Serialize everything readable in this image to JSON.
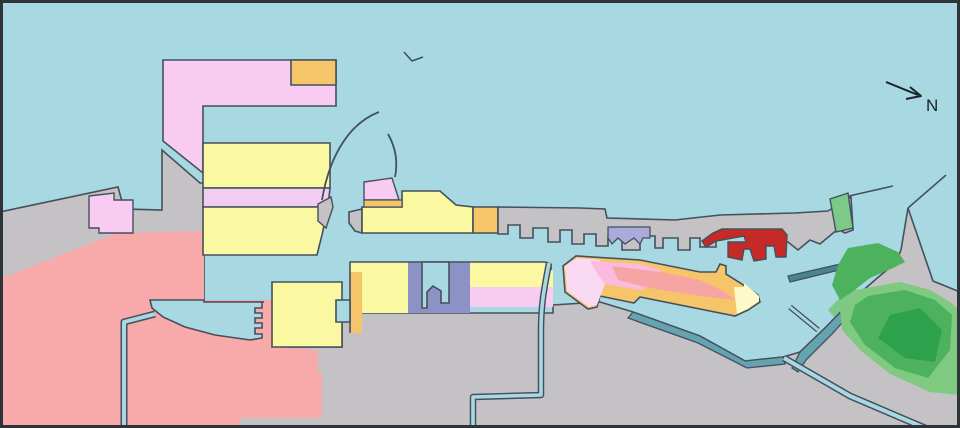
{
  "title": "Harbor land-use map",
  "compass": {
    "label": "N"
  },
  "palette": {
    "water": "#A8D8E1",
    "land_gray": "#C4C2C4",
    "outline": "#44505C",
    "frame": "#2F343B",
    "pink_zone": "#F8CBF3",
    "pink_band": "#F3CCF3",
    "yellow_zone": "#FBF8A2",
    "orange_zone": "#F6C469",
    "salmon_zone": "#F8A9A9",
    "red_zone": "#C62A26",
    "purple_zone": "#8C92C6",
    "lavender_zone": "#ABAADA",
    "teal_quay": "#65A3B0",
    "teal_dark": "#47858F",
    "green_strip": "#7CC98A",
    "green_light": "#7FC981",
    "green_mid": "#4DB25E",
    "green_dark": "#2DA14B",
    "pale_yellow": "#FDFAC9",
    "light_pink": "#FAD9F2",
    "bright_pink": "#FABBDE"
  },
  "map": {
    "width": 960,
    "height": 428,
    "background": "#A8D8E1",
    "shapes": [
      {
        "name": "west-mainland",
        "kind": "polygon",
        "fill": "#C4C2C4",
        "stroke": "#44505C",
        "sw": 1.6,
        "points": "0,212 118,187 124,209 162,210 162,150 200,183 204,183 204,428 0,428"
      },
      {
        "name": "south-east-landmass",
        "kind": "polygon",
        "fill": "#C4C2C4",
        "stroke": "#44505C",
        "sw": 1.6,
        "points": "204,302 272,302 272,347 342,347 342,302 352,302 352,313 553,313 553,305 600,302 633,312 700,336 745,361 783,357 800,352 825,328 852,300 875,280 896,262 901,250 908,208 933,281 960,292 960,428 204,428"
      },
      {
        "name": "salmon-district",
        "kind": "polygon",
        "fill": "#F8A9A9",
        "stroke": "none",
        "sw": 0,
        "points": "0,279 117,233 204,231 204,300 272,300 272,347 318,350 318,372 322,372 322,418 240,418 240,428 0,428"
      },
      {
        "name": "basin-west-shore-line",
        "kind": "path",
        "fill": "none",
        "stroke": "#44505C",
        "sw": 1.6,
        "d": "M 204,302 L 264,302"
      },
      {
        "name": "pink-patch-west",
        "kind": "polygon",
        "fill": "#F8CBF3",
        "stroke": "#44505C",
        "sw": 1.4,
        "points": "89,196 114,193 114,200 133,200 133,233 99,233 99,228 89,228"
      },
      {
        "name": "pink-terminal-complex",
        "kind": "polygon",
        "fill": "#F8CBF3",
        "stroke": "#44505C",
        "sw": 1.6,
        "points": "163,60 336,60 336,106 203,106 203,173 163,141"
      },
      {
        "name": "orange-terminal",
        "kind": "polygon",
        "fill": "#F6C469",
        "stroke": "#44505C",
        "sw": 1.6,
        "points": "291,60 336,60 336,85 291,85"
      },
      {
        "name": "left-pier-yellow-north",
        "kind": "polygon",
        "fill": "#FBF8A2",
        "stroke": "#44505C",
        "sw": 1.6,
        "points": "203,143 330,143 330,188 203,188"
      },
      {
        "name": "left-pier-pink-band",
        "kind": "polygon",
        "fill": "#F3CCF3",
        "stroke": "#44505C",
        "sw": 1.6,
        "points": "203,188 330,188 328,207 203,207"
      },
      {
        "name": "left-pier-yellow-south",
        "kind": "polygon",
        "fill": "#FBF8A2",
        "stroke": "#44505C",
        "sw": 1.6,
        "points": "203,207 328,207 322,235 317,255 203,255"
      },
      {
        "name": "pier-corner-wedge",
        "kind": "polygon",
        "fill": "#C4C2C4",
        "stroke": "#44505C",
        "sw": 1.4,
        "points": "318,204 331,197 333,207 326,228 318,221"
      },
      {
        "name": "central-pier-gray-tip",
        "kind": "polygon",
        "fill": "#C4C2C4",
        "stroke": "#44505C",
        "sw": 1.6,
        "points": "349,212 362,209 362,233 355,231 349,223"
      },
      {
        "name": "central-pier-yellow",
        "kind": "polygon",
        "fill": "#FBF8A2",
        "stroke": "#44505C",
        "sw": 1.6,
        "points": "362,207 402,207 402,191 440,191 456,205 473,207 473,233 362,233"
      },
      {
        "name": "central-pier-orange-end",
        "kind": "polygon",
        "fill": "#F6C469",
        "stroke": "#44505C",
        "sw": 1.6,
        "points": "473,207 498,207 498,233 473,233"
      },
      {
        "name": "central-pier-pink-block",
        "kind": "polygon",
        "fill": "#F8CBF3",
        "stroke": "#44505C",
        "sw": 1.4,
        "points": "364,182 392,178 399,200 364,200"
      },
      {
        "name": "central-pier-orange-strip",
        "kind": "polygon",
        "fill": "#F6C469",
        "stroke": "#44505C",
        "sw": 1.2,
        "points": "364,200 402,200 402,207 364,207"
      },
      {
        "name": "breakwater-arc-large",
        "kind": "path",
        "fill": "none",
        "stroke": "#44505C",
        "sw": 1.8,
        "d": "M 379,112 C 352,122 330,152 322,200"
      },
      {
        "name": "breakwater-arc-small",
        "kind": "path",
        "fill": "none",
        "stroke": "#44505C",
        "sw": 1.8,
        "d": "M 388,134 C 396,148 398,162 395,177"
      },
      {
        "name": "seamark-tick",
        "kind": "path",
        "fill": "none",
        "stroke": "#44505C",
        "sw": 1.6,
        "d": "M 404,52 L 412,61 L 423,57"
      },
      {
        "name": "north-shore-strip",
        "kind": "polygon",
        "fill": "#C4C2C4",
        "stroke": "#44505C",
        "sw": 1.6,
        "points": "498,207 580,208 605,209 607,218 675,220 720,215 795,213 828,211 851,197 853,230 845,233 838,229 820,244 810,240 798,250 788,242 756,242 756,236 716,236 716,247 700,247 700,238 690,238 690,250 678,250 678,238 663,238 663,248 655,248 655,236 640,236 640,250 622,250 622,238 608,238 608,246 596,246 596,234 584,234 584,244 572,244 572,230 560,230 560,242 548,242 548,228 533,228 533,238 520,238 520,225 508,225 508,234 498,234"
      },
      {
        "name": "lavender-zone",
        "kind": "polygon",
        "fill": "#ABAADA",
        "stroke": "#44505C",
        "sw": 1.3,
        "points": "608,227 650,227 650,238 643,238 640,244 634,238 625,244 618,238 612,244 608,238"
      },
      {
        "name": "red-zone",
        "kind": "polygon",
        "fill": "#C62A26",
        "stroke": "#44505C",
        "sw": 1.4,
        "points": "702,241 713,233 722,229 782,229 787,235 786,257 776,257 774,246 766,246 766,259 754,261 750,249 744,249 742,260 728,257 728,242 746,242 744,236 716,241 706,247"
      },
      {
        "name": "spit-green-strip",
        "kind": "polygon",
        "fill": "#7CC98A",
        "stroke": "#44505C",
        "sw": 1.4,
        "points": "830,199 848,193 853,228 836,232"
      },
      {
        "name": "spit-breakwater-line",
        "kind": "path",
        "fill": "none",
        "stroke": "#44505C",
        "sw": 1.5,
        "d": "M 849,196 L 893,186"
      },
      {
        "name": "east-seawall-line",
        "kind": "path",
        "fill": "none",
        "stroke": "#44505C",
        "sw": 1.5,
        "d": "M 946,175 L 908,208"
      },
      {
        "name": "diagonal-pier-base",
        "kind": "polygon",
        "fill": "#F6C469",
        "stroke": "#44505C",
        "sw": 1.6,
        "points": "563,266 576,256 640,260 700,272 716,272 720,264 726,266 726,274 745,286 758,295 760,302 748,310 735,316 640,297 634,303 600,296 597,307 588,309 565,292"
      },
      {
        "name": "diagonal-pier-lightpink-west",
        "kind": "polygon",
        "fill": "#FAD9F2",
        "stroke": "none",
        "sw": 0,
        "points": "565,266 577,258 600,260 605,284 597,305 589,307 567,291"
      },
      {
        "name": "diagonal-pier-brightpink",
        "kind": "polygon",
        "fill": "#FABBDE",
        "stroke": "none",
        "sw": 0,
        "points": "590,261 640,264 660,270 662,282 640,290 605,284 596,272"
      },
      {
        "name": "diagonal-pier-salmon-core",
        "kind": "polygon",
        "fill": "#F6A4A4",
        "stroke": "none",
        "sw": 0,
        "points": "612,266 660,272 700,280 725,292 735,300 700,296 650,288 618,280"
      },
      {
        "name": "diagonal-pier-paleyellow-tip",
        "kind": "polygon",
        "fill": "#FDFAC9",
        "stroke": "none",
        "sw": 0,
        "points": "734,287 744,287 744,283 759,296 759,301 748,309 737,314"
      },
      {
        "name": "south-yellow-pier",
        "kind": "polygon",
        "fill": "#FBF8A2",
        "stroke": "#44505C",
        "sw": 1.6,
        "points": "272,282 342,282 342,347 272,347"
      },
      {
        "name": "zone-yellow-west",
        "kind": "polygon",
        "fill": "#FBF8A2",
        "stroke": "none",
        "sw": 0,
        "points": "350,262 408,262 408,313 350,313"
      },
      {
        "name": "zone-orange-strip",
        "kind": "polygon",
        "fill": "#F6C469",
        "stroke": "none",
        "sw": 0,
        "points": "350,272 362,272 362,333 350,333"
      },
      {
        "name": "zone-purple",
        "kind": "polygon",
        "fill": "#8C92C6",
        "stroke": "none",
        "sw": 0,
        "points": "408,262 470,262 470,313 408,313"
      },
      {
        "name": "zone-yellow-east",
        "kind": "polygon",
        "fill": "#FBF8A2",
        "stroke": "none",
        "sw": 0,
        "points": "470,262 544,262 553,271 553,287 470,287"
      },
      {
        "name": "zone-pink-east",
        "kind": "polygon",
        "fill": "#F8CBF3",
        "stroke": "none",
        "sw": 0,
        "points": "470,287 553,287 553,307 470,307"
      },
      {
        "name": "zones-west-coast-line",
        "kind": "path",
        "fill": "none",
        "stroke": "#44505C",
        "sw": 1.6,
        "d": "M 350,333 L 350,262 L 470,262"
      },
      {
        "name": "zones-east-coast-line",
        "kind": "path",
        "fill": "none",
        "stroke": "#44505C",
        "sw": 1.6,
        "d": "M 470,262 L 545,262 Q 552,263 551,270"
      },
      {
        "name": "purple-basin-water",
        "kind": "polygon",
        "fill": "#A8D8E1",
        "stroke": "#44505C",
        "sw": 1.6,
        "points": "422,262 449,262 449,303 441,303 441,291 433,286 427,292 427,308 422,308"
      },
      {
        "name": "slip-water",
        "kind": "polygon",
        "fill": "#A8D8E1",
        "stroke": "#44505C",
        "sw": 1.6,
        "points": "336,300 350,300 350,322 336,322"
      },
      {
        "name": "inlet-water",
        "kind": "polygon",
        "fill": "#A8D8E1",
        "stroke": "#44505C",
        "sw": 1.6,
        "points": "150,300 204,300 204,302 262,302 262,308 255,308 255,313 262,313 262,318 255,318 255,323 262,323 262,328 255,328 255,334 262,334 262,338 250,340 215,335 185,327 163,317 152,308"
      },
      {
        "name": "canal-west-outline",
        "kind": "path",
        "fill": "none",
        "stroke": "#44505C",
        "sw": 7,
        "d": "M 155,314 L 124,322 L 124,428"
      },
      {
        "name": "canal-west-water",
        "kind": "path",
        "fill": "none",
        "stroke": "#A8D8E1",
        "sw": 4,
        "d": "M 155,314 L 124,322 L 124,428"
      },
      {
        "name": "teal-quay",
        "kind": "polygon",
        "fill": "#65A3B0",
        "stroke": "#44505C",
        "sw": 1.3,
        "points": "633,312 700,336 745,361 783,357 785,364 747,368 698,343 628,318"
      },
      {
        "name": "detached-breakwater",
        "kind": "polygon",
        "fill": "#65A3B0",
        "stroke": "#44505C",
        "sw": 1.3,
        "points": "792,368 800,352 825,328 852,300 858,305 832,334 806,360 798,372"
      },
      {
        "name": "breakwater-green-strip",
        "kind": "polygon",
        "fill": "#7CC98A",
        "stroke": "none",
        "sw": 0,
        "points": "828,310 852,285 858,292 834,317"
      },
      {
        "name": "thin-jetty",
        "kind": "polygon",
        "fill": "#47858F",
        "stroke": "#44505C",
        "sw": 1.2,
        "points": "788,276 875,256 876,261 790,282"
      },
      {
        "name": "jetty-slip-outline",
        "kind": "path",
        "fill": "none",
        "stroke": "#44505C",
        "sw": 5.5,
        "d": "M 790,307 L 818,330"
      },
      {
        "name": "jetty-slip-water",
        "kind": "path",
        "fill": "none",
        "stroke": "#A8D8E1",
        "sw": 3,
        "d": "M 790,307 L 818,330"
      },
      {
        "name": "east-green-lobe",
        "kind": "polygon",
        "fill": "#4DB25E",
        "stroke": "none",
        "sw": 0,
        "points": "848,248 878,243 898,252 905,262 893,268 870,278 852,292 840,300 832,285 838,265"
      },
      {
        "name": "park-green-light",
        "kind": "polygon",
        "fill": "#7FC981",
        "stroke": "none",
        "sw": 0,
        "points": "855,290 900,282 930,290 950,302 960,310 960,395 930,392 890,374 860,350 842,330 840,310"
      },
      {
        "name": "park-green-mid",
        "kind": "polygon",
        "fill": "#4DB25E",
        "stroke": "none",
        "sw": 0,
        "points": "868,296 905,290 935,300 952,315 950,350 928,378 895,368 865,345 850,322 855,305"
      },
      {
        "name": "park-green-dark",
        "kind": "polygon",
        "fill": "#2DA14B",
        "stroke": "none",
        "sw": 0,
        "points": "890,315 920,308 942,330 935,362 905,358 878,338"
      },
      {
        "name": "canal-south-outline",
        "kind": "path",
        "fill": "none",
        "stroke": "#44505C",
        "sw": 6.5,
        "d": "M 549,263 C 545,285 541,302 541,330 L 541,395 L 473,397 L 473,428"
      },
      {
        "name": "canal-south-water",
        "kind": "path",
        "fill": "none",
        "stroke": "#A8D8E1",
        "sw": 3.6,
        "d": "M 549,263 C 545,285 541,302 541,330 L 541,395 L 473,397 L 473,428"
      },
      {
        "name": "canal-southeast-outline",
        "kind": "path",
        "fill": "none",
        "stroke": "#44505C",
        "sw": 7,
        "d": "M 784,358 L 850,396 L 925,428"
      },
      {
        "name": "canal-southeast-water",
        "kind": "path",
        "fill": "none",
        "stroke": "#A8D8E1",
        "sw": 4,
        "d": "M 784,358 L 850,396 L 925,428"
      },
      {
        "name": "compass-arrow-shaft",
        "kind": "path",
        "fill": "none",
        "stroke": "#1A222B",
        "sw": 2,
        "d": "M 886,82 L 918,95"
      },
      {
        "name": "compass-arrow-head",
        "kind": "path",
        "fill": "none",
        "stroke": "#1A222B",
        "sw": 2,
        "d": "M 910,87 L 921,96 L 906,99"
      },
      {
        "name": "compass-label",
        "kind": "text",
        "x": 926,
        "y": 111,
        "size": 17,
        "fill": "#1A222B",
        "bind": "compass.label"
      },
      {
        "name": "map-frame",
        "kind": "rect",
        "x": 1.5,
        "y": 1.5,
        "w": 957,
        "h": 425,
        "fill": "none",
        "stroke": "#2F343B",
        "sw": 3
      }
    ]
  }
}
